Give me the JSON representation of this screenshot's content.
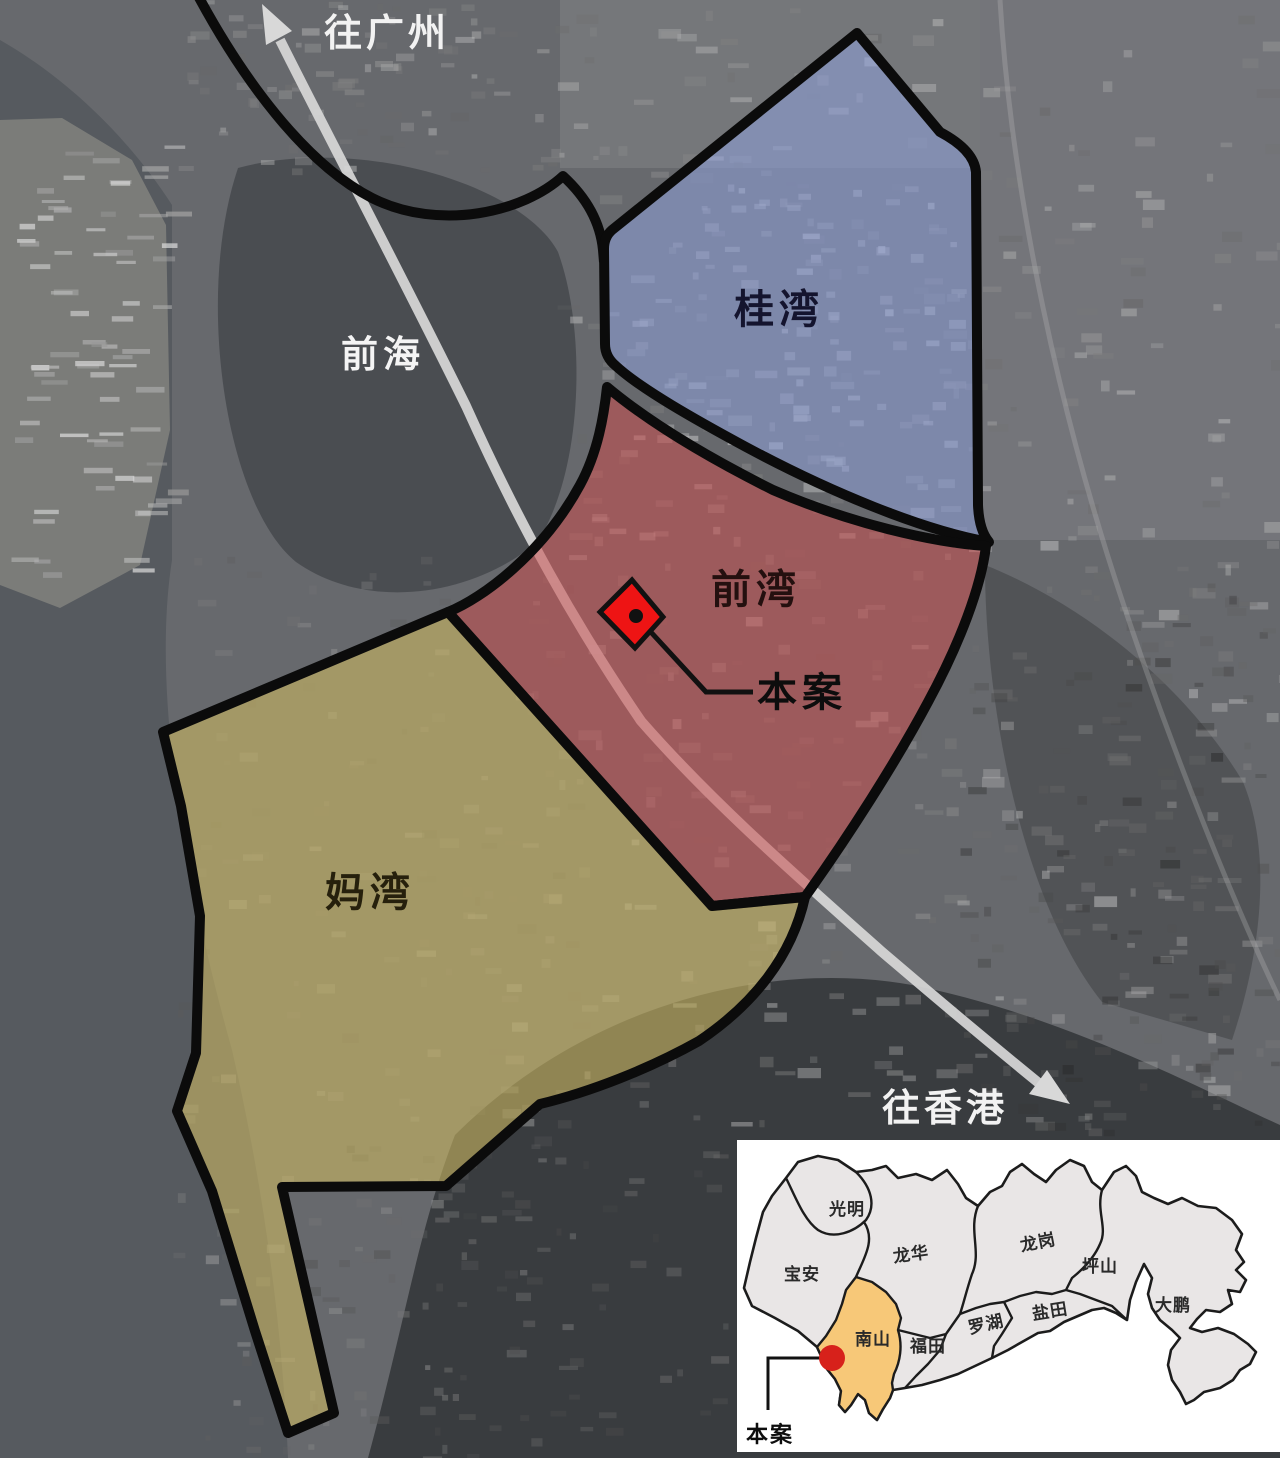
{
  "main_map": {
    "arrow_labels": {
      "to_guangzhou": "往广州",
      "to_hongkong": "往香港"
    },
    "water_label": "前海",
    "regions": [
      {
        "label": "桂湾",
        "fill": "#8e9fd8"
      },
      {
        "label": "前湾",
        "fill": "#cb4f4f"
      },
      {
        "label": "妈湾",
        "fill": "#cfba62"
      }
    ],
    "site_callout": {
      "label": "本案",
      "marker_color": "#ee1414"
    }
  },
  "inset_map": {
    "districts": [
      {
        "label": "光明"
      },
      {
        "label": "宝安"
      },
      {
        "label": "龙华"
      },
      {
        "label": "龙岗"
      },
      {
        "label": "坪山"
      },
      {
        "label": "盐田"
      },
      {
        "label": "罗湖"
      },
      {
        "label": "福田"
      },
      {
        "label": "南山"
      },
      {
        "label": "大鹏"
      }
    ],
    "highlighted_district": "南山",
    "highlight_color": "#f7c878",
    "site_callout": {
      "label": "本案",
      "dot_color": "#d7211b"
    }
  }
}
